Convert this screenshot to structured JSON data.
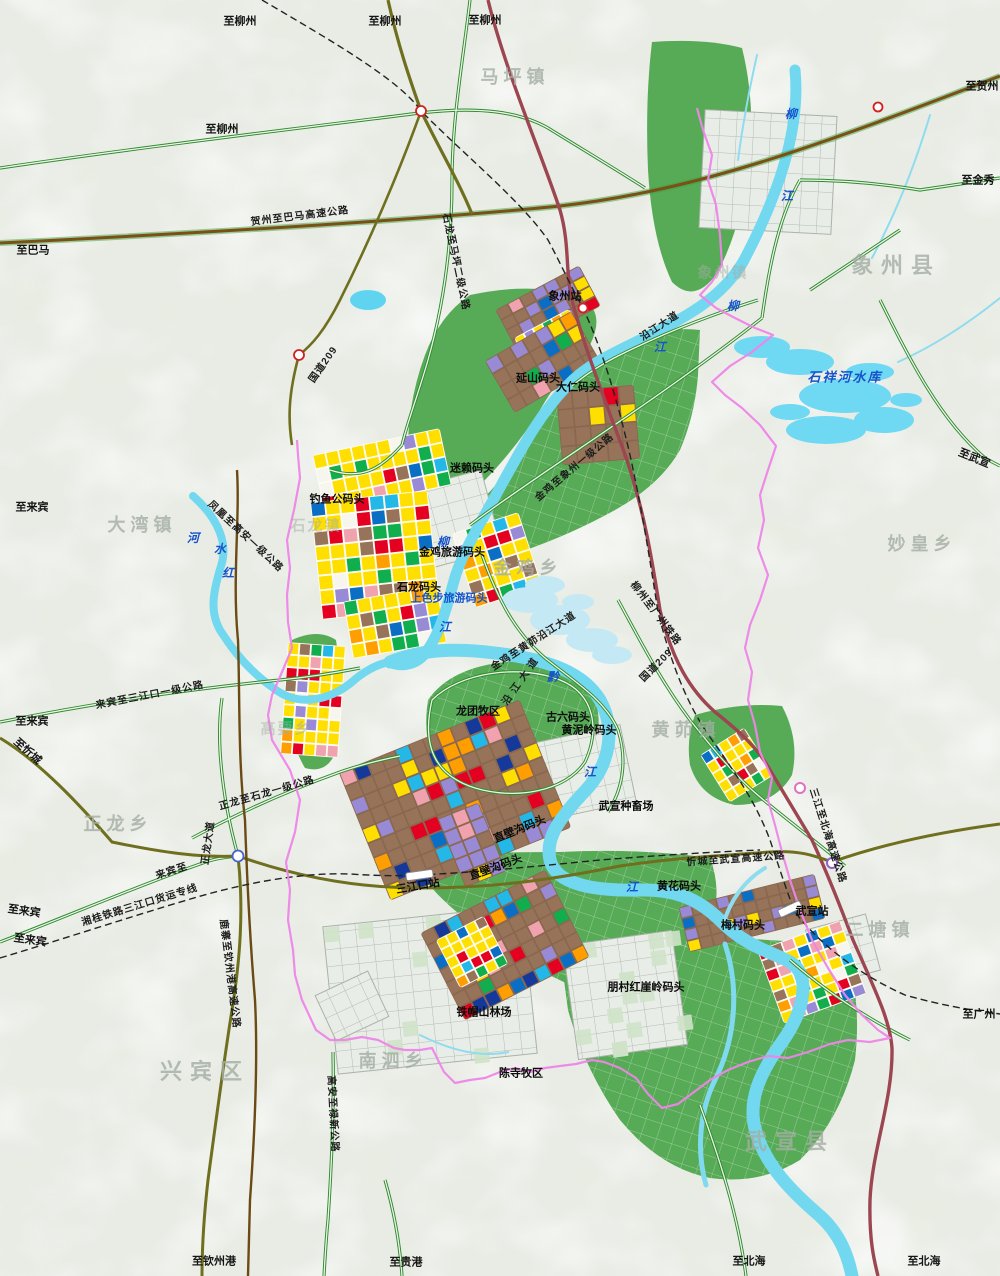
{
  "map": {
    "title": "石龙三江口港区城市规划图",
    "colors": {
      "background": "#e9ece5",
      "forest_green": "#57ab57",
      "river_cyan": "#72d8ef",
      "reservoir_cyan": "#6fd8f2",
      "residential_yellow": "#ffdf00",
      "industry_red": "#e30021",
      "village_brown": "#977459",
      "public_purple": "#998ad6",
      "boundary_magenta": "#ee85e8",
      "expressway_olive": "#6f6f1f",
      "expressway_maroon": "#9c4652",
      "highway_brown": "#7a5016",
      "road_green": "#2d8c2d",
      "railway_black": "#222222"
    },
    "edge_labels": [
      {
        "t": "至柳州",
        "x": 240,
        "y": 22
      },
      {
        "t": "至柳州",
        "x": 385,
        "y": 22
      },
      {
        "t": "至柳州",
        "x": 485,
        "y": 21
      },
      {
        "t": "至贺州",
        "x": 982,
        "y": 87
      },
      {
        "t": "至柳州",
        "x": 222,
        "y": 130
      },
      {
        "t": "至金秀",
        "x": 978,
        "y": 181
      },
      {
        "t": "至巴马",
        "x": 33,
        "y": 251
      },
      {
        "t": "至来宾",
        "x": 32,
        "y": 508
      },
      {
        "t": "至来宾",
        "x": 32,
        "y": 722
      },
      {
        "t": "至忻城",
        "x": 27,
        "y": 752,
        "r": 42
      },
      {
        "t": "至来宾",
        "x": 24,
        "y": 912,
        "r": 8
      },
      {
        "t": "至来宾",
        "x": 30,
        "y": 941,
        "r": 8
      },
      {
        "t": "至武宣",
        "x": 974,
        "y": 459,
        "r": 22
      },
      {
        "t": "至广州",
        "x": 979,
        "y": 1015
      },
      {
        "t": "至钦州港",
        "x": 214,
        "y": 1262
      },
      {
        "t": "至贵港",
        "x": 406,
        "y": 1263
      },
      {
        "t": "至北海",
        "x": 749,
        "y": 1262
      },
      {
        "t": "至北海",
        "x": 924,
        "y": 1262
      }
    ],
    "district_labels": [
      {
        "t": "马坪镇",
        "x": 515,
        "y": 77
      },
      {
        "t": "象州县",
        "x": 896,
        "y": 266,
        "big": true
      },
      {
        "t": "象州镇",
        "x": 723,
        "y": 273,
        "faint": true
      },
      {
        "t": "大湾镇",
        "x": 142,
        "y": 525
      },
      {
        "t": "石龙镇",
        "x": 316,
        "y": 526,
        "faint": true
      },
      {
        "t": "金鸡乡",
        "x": 528,
        "y": 568
      },
      {
        "t": "妙皇乡",
        "x": 922,
        "y": 544
      },
      {
        "t": "高要乡",
        "x": 286,
        "y": 729,
        "faint": true
      },
      {
        "t": "黄茆镇",
        "x": 686,
        "y": 730
      },
      {
        "t": "正龙乡",
        "x": 118,
        "y": 824
      },
      {
        "t": "二塘镇",
        "x": 880,
        "y": 930
      },
      {
        "t": "南泗乡",
        "x": 393,
        "y": 1061
      },
      {
        "t": "兴宾区",
        "x": 205,
        "y": 1072,
        "big": true
      },
      {
        "t": "武宣县",
        "x": 790,
        "y": 1142,
        "big": true
      }
    ],
    "road_labels": [
      {
        "t": "贺州至巴马高速公路",
        "x": 300,
        "y": 217,
        "r": -7
      },
      {
        "t": "石龙至马坪二级公路",
        "x": 455,
        "y": 262,
        "r": 78
      },
      {
        "t": "国道209",
        "x": 324,
        "y": 365,
        "r": -55
      },
      {
        "t": "沿江大道",
        "x": 660,
        "y": 327,
        "r": -33
      },
      {
        "t": "金鸡至象州一级公路",
        "x": 575,
        "y": 468,
        "r": -40
      },
      {
        "t": "凤凰至高安一级公路",
        "x": 245,
        "y": 537,
        "r": 43
      },
      {
        "t": "金鸡至黄茆沿江大道",
        "x": 534,
        "y": 642,
        "r": -33
      },
      {
        "t": "沿 江 大 道",
        "x": 521,
        "y": 682,
        "r": -55
      },
      {
        "t": "国道209",
        "x": 657,
        "y": 666,
        "r": -45
      },
      {
        "t": "来宾至三江口一级公路",
        "x": 150,
        "y": 696,
        "r": -11
      },
      {
        "t": "正龙至石龙一级公路",
        "x": 267,
        "y": 794,
        "r": -16
      },
      {
        "t": "正龙大道",
        "x": 209,
        "y": 843,
        "r": -82
      },
      {
        "t": "来宾至",
        "x": 172,
        "y": 872,
        "r": -18
      },
      {
        "t": "忻城至武宣高速公路",
        "x": 736,
        "y": 860,
        "r": -4
      },
      {
        "t": "三江至北海高速公路",
        "x": 827,
        "y": 836,
        "r": 72
      },
      {
        "t": "鹿寨至钦州港高速公路",
        "x": 229,
        "y": 974,
        "r": 83
      },
      {
        "t": "高安至禄新公路",
        "x": 332,
        "y": 1114,
        "r": 87
      }
    ],
    "railway_labels": [
      {
        "t": "柳州至广州铁路",
        "x": 655,
        "y": 614,
        "r": 53
      },
      {
        "t": "湘桂铁路三江口货运专线",
        "x": 140,
        "y": 906,
        "r": -17
      }
    ],
    "water_labels": [
      {
        "t": "柳",
        "x": 791,
        "y": 114
      },
      {
        "t": "江",
        "x": 787,
        "y": 196
      },
      {
        "t": "柳",
        "x": 733,
        "y": 306
      },
      {
        "t": "江",
        "x": 660,
        "y": 347
      },
      {
        "t": "柳",
        "x": 443,
        "y": 542
      },
      {
        "t": "江",
        "x": 445,
        "y": 627
      },
      {
        "t": "河",
        "x": 193,
        "y": 538
      },
      {
        "t": "水",
        "x": 220,
        "y": 549
      },
      {
        "t": "红",
        "x": 228,
        "y": 573
      },
      {
        "t": "黔",
        "x": 553,
        "y": 677
      },
      {
        "t": "江",
        "x": 590,
        "y": 772
      },
      {
        "t": "江",
        "x": 632,
        "y": 887
      },
      {
        "t": "石祥河水库",
        "x": 845,
        "y": 377,
        "big": true
      }
    ],
    "site_labels": [
      {
        "t": "象州站",
        "x": 565,
        "y": 297
      },
      {
        "t": "延山码头",
        "x": 538,
        "y": 379
      },
      {
        "t": "大仁码头",
        "x": 578,
        "y": 388
      },
      {
        "t": "迷赖码头",
        "x": 472,
        "y": 469
      },
      {
        "t": "钓鱼公码头",
        "x": 337,
        "y": 500
      },
      {
        "t": "金鸡旅游码头",
        "x": 452,
        "y": 553
      },
      {
        "t": "石龙码头",
        "x": 419,
        "y": 588
      },
      {
        "t": "上色步旅游码头",
        "x": 449,
        "y": 599,
        "blue": true
      },
      {
        "t": "龙团牧区",
        "x": 478,
        "y": 712
      },
      {
        "t": "古六码头",
        "x": 568,
        "y": 718
      },
      {
        "t": "黄泥岭码头",
        "x": 589,
        "y": 731
      },
      {
        "t": "武宣种畜场",
        "x": 626,
        "y": 807
      },
      {
        "t": "直壁沟码头",
        "x": 520,
        "y": 830,
        "r": -22
      },
      {
        "t": "直壁沟码头",
        "x": 496,
        "y": 868,
        "r": -20
      },
      {
        "t": "三江口站",
        "x": 418,
        "y": 887,
        "r": -10
      },
      {
        "t": "黄花码头",
        "x": 679,
        "y": 887
      },
      {
        "t": "武宣站",
        "x": 812,
        "y": 912
      },
      {
        "t": "梅村码头",
        "x": 743,
        "y": 926
      },
      {
        "t": "朋村红崖岭码头",
        "x": 646,
        "y": 988
      },
      {
        "t": "铁帽山林场",
        "x": 484,
        "y": 1013
      },
      {
        "t": "陈寺牧区",
        "x": 521,
        "y": 1074
      }
    ]
  }
}
